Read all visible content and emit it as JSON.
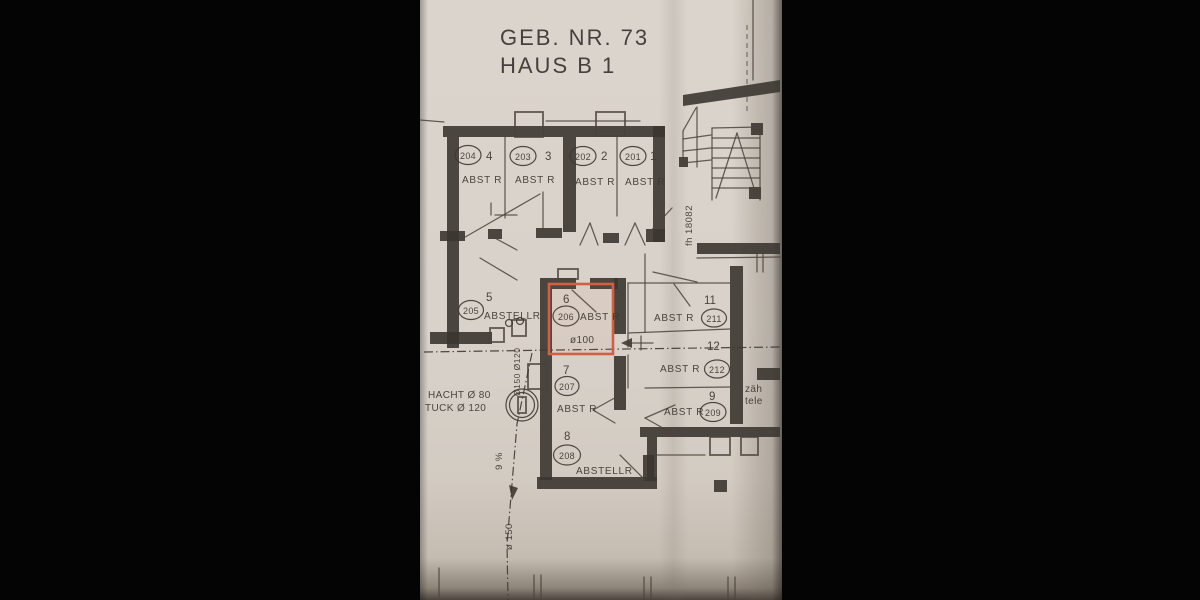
{
  "title": {
    "line1": "GEB. NR. 73",
    "line2": "HAUS B 1"
  },
  "rooms": [
    {
      "unit": "4",
      "id": "204",
      "label": "ABST R"
    },
    {
      "unit": "3",
      "id": "203",
      "label": "ABST R"
    },
    {
      "unit": "2",
      "id": "202",
      "label": "ABST R"
    },
    {
      "unit": "1",
      "id": "201",
      "label": "ABST R"
    },
    {
      "unit": "5",
      "id": "205",
      "label": "ABSTELLR"
    },
    {
      "unit": "6",
      "id": "206",
      "label": "ABST R",
      "diameter": "ø100",
      "highlighted": true
    },
    {
      "unit": "11",
      "id": "211",
      "label": "ABST R"
    },
    {
      "unit": "12",
      "id": "212",
      "label": "ABST R"
    },
    {
      "unit": "7",
      "id": "207",
      "label": "ABST R"
    },
    {
      "unit": "9",
      "id": "209",
      "label": "ABST R"
    },
    {
      "unit": "8",
      "id": "208",
      "label": "ABSTELLR"
    }
  ],
  "annotations": {
    "shaft_line1": "HACHT Ø 80",
    "shaft_line2": "TUCK Ø 120",
    "meter_line1": "zäh",
    "meter_line2": "tele",
    "stair_note": "fh 18082",
    "slope": "9 %",
    "pipe_mid": "Ø150 Ø120",
    "pipe_bottom": "ø 150"
  },
  "colors": {
    "highlight": "#d05f45",
    "ink": "#3b3630",
    "paper": "#d8d2ca"
  }
}
